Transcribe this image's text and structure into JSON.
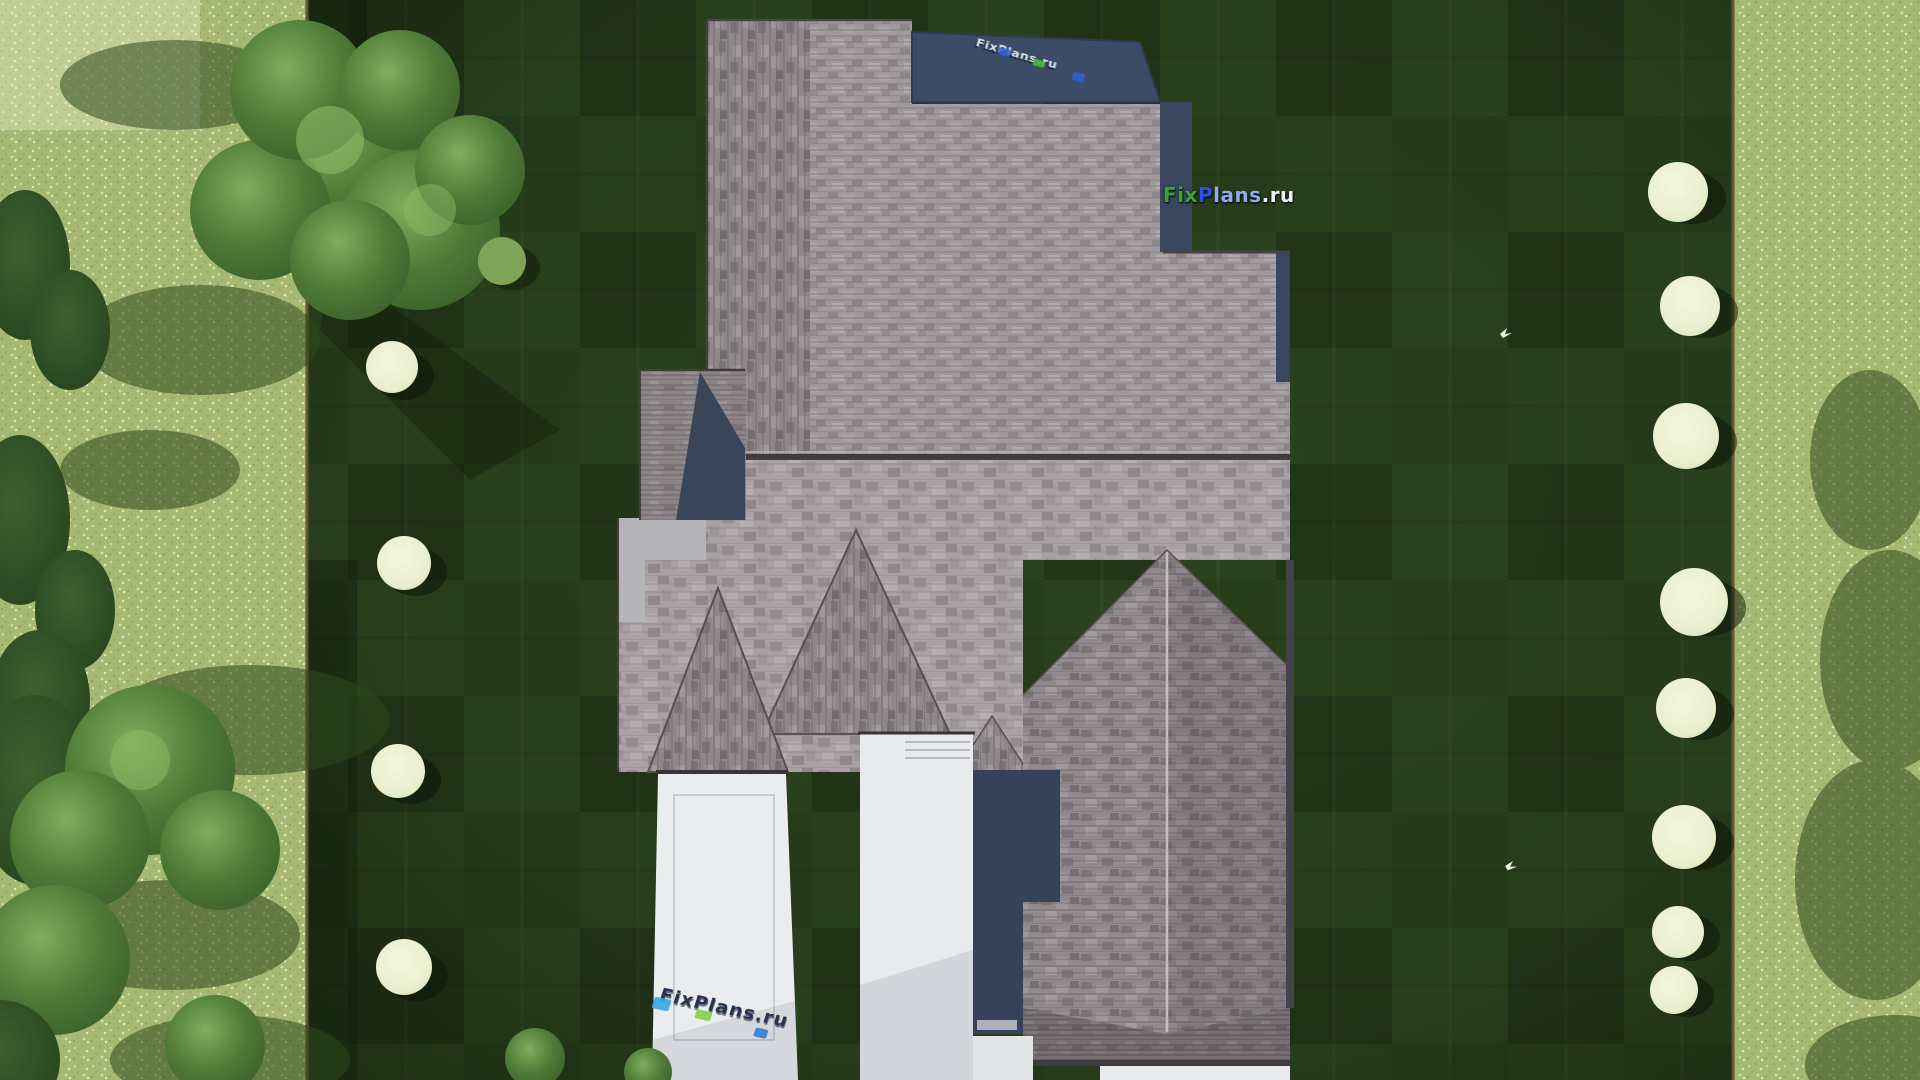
{
  "watermarks": {
    "logo": {
      "fix": "Fix",
      "p": "P",
      "lans": "lans",
      "ru": ".ru",
      "fix_color": "#3ba432",
      "p_color": "#2a54e4",
      "lans_color": "#93a9ee",
      "ru_color": "#edf2fa"
    },
    "roof_top": {
      "text": "FixPlans.ru",
      "base_color": "#e4e9f0",
      "accent_blue": "#2f63d0",
      "accent_green": "#47b83a"
    },
    "driveway": {
      "text": "FixPlans.ru",
      "base_color": "#273150",
      "accent_cyan": "#35a9e8",
      "accent_green": "#7ed23f",
      "accent_blue": "#2f7fd0"
    }
  },
  "scene": {
    "type": "aerial-architectural-render",
    "counts": {
      "birds": 2,
      "white_bushes_left": 4,
      "white_bushes_right": 8
    },
    "colors": {
      "lawn_dark": "#253b19",
      "lawn_stripe": "#2c451f",
      "meadow": "#a6b973",
      "roof_light": "#a19a9d",
      "roof_pale": "#a8a2a5",
      "roof_mid": "#918a8d",
      "roof_dark": "#766f72",
      "flat_roof_navy": "#3d4c66",
      "shadow_navy": "#364258",
      "driveway_white": "#eaecee",
      "wall_light": "#b5b5b9",
      "fence_brown": "#6b5138",
      "tree_green": "#4e7a37",
      "conifer_green": "#2c4a22",
      "blossom": "#eef2d4",
      "bird_white": "#f0f0ea"
    }
  }
}
